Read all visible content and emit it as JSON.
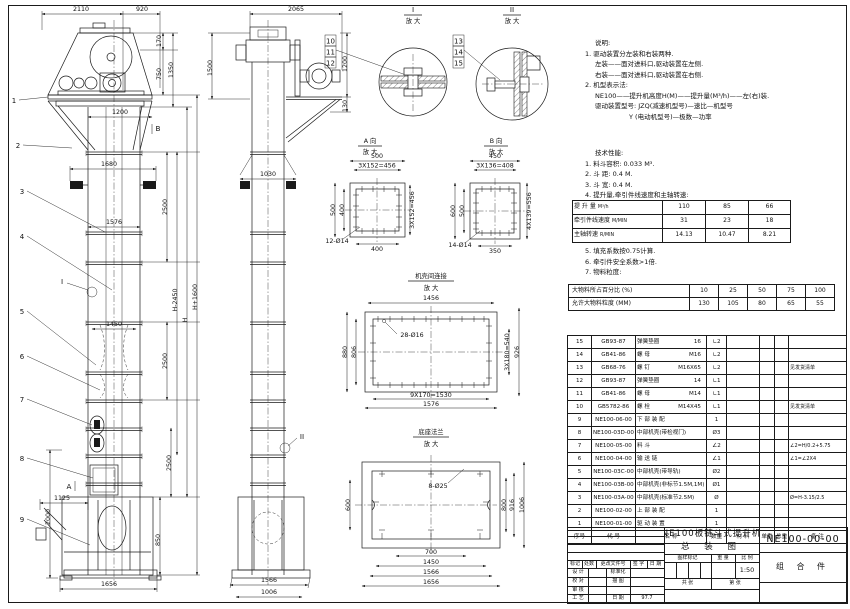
{
  "colors": {
    "line": "#1a1a1a",
    "background": "#ffffff"
  },
  "notes": {
    "title": "说明:",
    "n1": "1. 驱动装置分左装和右装两种.",
    "n1a": "左装——面对进料口,驱动装置在左侧.",
    "n1b": "右装——面对进料口,驱动装置在右侧.",
    "n2": "2. 机型表示法:",
    "n2a": "NE100——提升机高度H(M)——提升量(M³/h)——左(右)装.",
    "n2b": "驱动装置型号: JZQ(减速机型号)—速比—机型号",
    "n2c": "Y (电动机型号)—极数—功率"
  },
  "specs": {
    "title": "技术性能:",
    "s1": "1. 料斗容积: 0.033 M³.",
    "s2": "2. 斗  距: 0.4 M.",
    "s3": "3. 斗  宽: 0.4 M.",
    "s4": "4. 提升量,牵引件线速度和主轴转速:",
    "s5": "5. 填充系数按0.75计算.",
    "s6": "6. 牵引件安全系数>1倍.",
    "s7": "7. 物料粒度:"
  },
  "perf_table": {
    "rows": [
      {
        "label": "提 升 量",
        "unit": "M³/h",
        "v1": "110",
        "v2": "85",
        "v3": "66"
      },
      {
        "label": "牵引件线速度",
        "unit": "M/MIN",
        "v1": "31",
        "v2": "23",
        "v3": "18"
      },
      {
        "label": "主轴转速",
        "unit": "R/MIN",
        "v1": "14.13",
        "v2": "10.47",
        "v3": "8.21"
      }
    ]
  },
  "size_table": {
    "row1": [
      "大物料所占百分比 (%)",
      "10",
      "25",
      "50",
      "75",
      "100"
    ],
    "row2": [
      "允许大物料粒度 (MM)",
      "130",
      "105",
      "80",
      "65",
      "55"
    ]
  },
  "bom": {
    "headers": {
      "no": "序号",
      "code": "代  号",
      "name": "名    称",
      "qty": "数量",
      "mat": "材  料",
      "uw": "单重",
      "tw": "总重",
      "remark": "备  注"
    },
    "rows": [
      {
        "no": "15",
        "code": "GB93-87",
        "name": "弹簧垫圈",
        "spec": "16",
        "qty": "∟2",
        "remark": ""
      },
      {
        "no": "14",
        "code": "GB41-86",
        "name": "螺  母",
        "spec": "M16",
        "qty": "∟2",
        "remark": ""
      },
      {
        "no": "13",
        "code": "GB68-76",
        "name": "螺  钉",
        "spec": "M16X65",
        "qty": "∟2",
        "remark": "见发货清单"
      },
      {
        "no": "12",
        "code": "GB93-87",
        "name": "弹簧垫圈",
        "spec": "14",
        "qty": "∟1",
        "remark": ""
      },
      {
        "no": "11",
        "code": "GB41-86",
        "name": "螺  母",
        "spec": "M14",
        "qty": "∟1",
        "remark": ""
      },
      {
        "no": "10",
        "code": "GB5782-86",
        "name": "螺  栓",
        "spec": "M14X45",
        "qty": "∟1",
        "remark": "见发货清单"
      },
      {
        "no": "9",
        "code": "NE100-06-00",
        "name": "下 部 装 配",
        "spec": "",
        "qty": "1",
        "remark": ""
      },
      {
        "no": "8",
        "code": "NE100-03D-00",
        "name": "中部机壳(带检视门)",
        "spec": "",
        "qty": "Ø3",
        "remark": ""
      },
      {
        "no": "7",
        "code": "NE100-05-00",
        "name": "料  斗",
        "spec": "",
        "qty": "∠2",
        "remark": "∠2=H/0.2+5.75"
      },
      {
        "no": "6",
        "code": "NE100-04-00",
        "name": "输 送 链",
        "spec": "",
        "qty": "∠1",
        "remark": "∠1=∠2X4"
      },
      {
        "no": "5",
        "code": "NE100-03C-00",
        "name": "中部机壳(带导轨)",
        "spec": "",
        "qty": "Ø2",
        "remark": ""
      },
      {
        "no": "4",
        "code": "NE100-03B-00",
        "name": "中部机壳(非标节1.5M,1M)",
        "spec": "",
        "qty": "Ø1",
        "remark": ""
      },
      {
        "no": "3",
        "code": "NE100-03A-00",
        "name": "中部机壳(标准节2.5M)",
        "spec": "",
        "qty": "Ø",
        "remark": "Ø=H-3.15/2.5"
      },
      {
        "no": "2",
        "code": "NE100-02-00",
        "name": "上 部 装 配",
        "spec": "",
        "qty": "1",
        "remark": ""
      },
      {
        "no": "1",
        "code": "NE100-01-00",
        "name": "驱 动 装 置",
        "spec": "",
        "qty": "1",
        "remark": ""
      }
    ]
  },
  "titleblock": {
    "title_line1": "NE100板链斗式提升机",
    "title_line2": "总 装 图",
    "drawing_no": "NE100-00-00",
    "part_type": "组 合 件",
    "mark_label": "图样标记",
    "weight_label": "重 量",
    "scale_label": "比 例",
    "scale": "1:50",
    "design": "设 计",
    "check": "校 对",
    "audit": "审 核",
    "process": "工 艺",
    "standard": "标准化",
    "trace": "描 图",
    "date_label": "日 期",
    "date": "97.7",
    "mark": "标记",
    "count": "处数",
    "change_doc": "更改文件号",
    "sign": "签 字",
    "date2": "日 期",
    "sheets_total": "共  张",
    "sheet_no": "第  张"
  },
  "details": {
    "d1": {
      "label": "I",
      "sub": "放 大"
    },
    "d2": {
      "label": "II",
      "sub": "放 大"
    },
    "a": {
      "label": "A 向",
      "sub": "放 大"
    },
    "b": {
      "label": "B 向",
      "sub": "放 大"
    },
    "casing": {
      "label": "机壳间连接",
      "sub": "放 大"
    },
    "base": {
      "label": "底座法兰",
      "sub": "放 大"
    }
  },
  "dims": {
    "f2110": "2110",
    "f920": "920",
    "f170": "170",
    "f750": "750",
    "f1350": "1350",
    "f1200": "1200",
    "f1680": "1680",
    "f2500a": "2500",
    "f1576": "1576",
    "fh2450": "H-2450",
    "fh": "H",
    "fh1600": "H+1600",
    "f1450": "1450",
    "f2500b": "2500",
    "f2500c": "2500",
    "f1125": "1125",
    "f2000": "2000",
    "f850": "850",
    "f1656": "1656",
    "s2065": "2065",
    "s1500": "1500",
    "s1200": "1200",
    "s130": "130",
    "s1030": "1030",
    "s1566": "1566",
    "s1006": "1006",
    "a500t": "500",
    "a456t": "3X152=456",
    "a500l": "500",
    "a400l": "400",
    "a456r": "3X152=456",
    "a400b": "400",
    "aholes": "12-Ø14",
    "b450": "450",
    "b408": "3X136=408",
    "b600": "600",
    "b500": "500",
    "b556": "4X139=556",
    "b350": "350",
    "bholes": "14-Ø14",
    "c1456": "1456",
    "choles": "28-Ø16",
    "c880": "880",
    "c806": "806",
    "c540": "3X180=540",
    "c926": "926",
    "c1530": "9X170=1530",
    "c1576": "1576",
    "gholes": "8-Ø25",
    "g600": "600",
    "g800": "800",
    "g916": "916",
    "g1006": "1006",
    "g700": "700",
    "g1450": "1450",
    "g1566": "1566",
    "g1656": "1656",
    "la": "A",
    "lb": "B",
    "li": "I",
    "lii": "II"
  },
  "balloons": {
    "b1": "1",
    "b2": "2",
    "b3": "3",
    "b4": "4",
    "b5": "5",
    "b6": "6",
    "b7": "7",
    "b8": "8",
    "b9": "9",
    "b10": "10",
    "b11": "11",
    "b12": "12",
    "b13": "13",
    "b14": "14",
    "b15": "15"
  }
}
